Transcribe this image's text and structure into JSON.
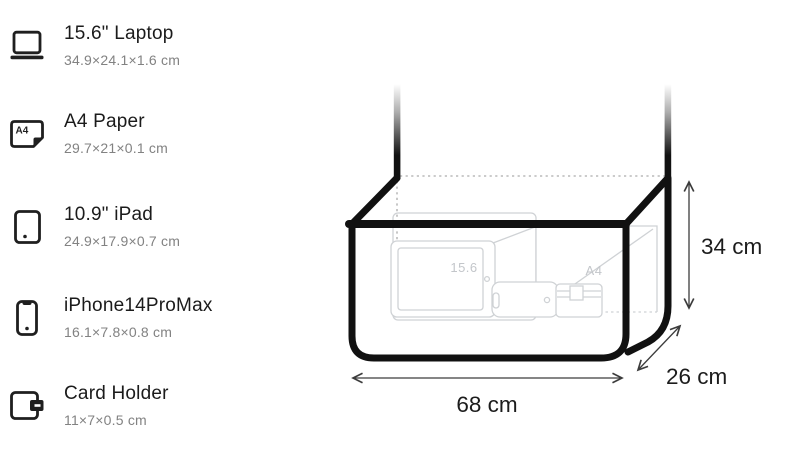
{
  "items": [
    {
      "icon": "laptop-icon",
      "title": "15.6\" Laptop",
      "dims": "34.9×24.1×1.6 cm"
    },
    {
      "icon": "a4-paper-icon",
      "title": "A4 Paper",
      "dims": "29.7×21×0.1 cm",
      "icon_label": "A4"
    },
    {
      "icon": "ipad-icon",
      "title": "10.9\" iPad",
      "dims": "24.9×17.9×0.7 cm"
    },
    {
      "icon": "iphone-icon",
      "title": "iPhone14ProMax",
      "dims": "16.1×7.8×0.8 cm"
    },
    {
      "icon": "card-holder-icon",
      "title": "Card Holder",
      "dims": "11×7×0.5 cm"
    }
  ],
  "diagram": {
    "width_label": "68 cm",
    "depth_label": "26 cm",
    "height_label": "34 cm",
    "ghost_labels": {
      "laptop": "15.6",
      "paper": "A4"
    },
    "colors": {
      "bag_outline": "#111111",
      "ghost_outline": "#cfd2d5",
      "ghost_text": "#c3c6ca",
      "dotted_edge": "#bababa",
      "arrow": "#3c3c3c",
      "label_text": "#1c1c1c",
      "icon": "#1f1f1f"
    }
  }
}
